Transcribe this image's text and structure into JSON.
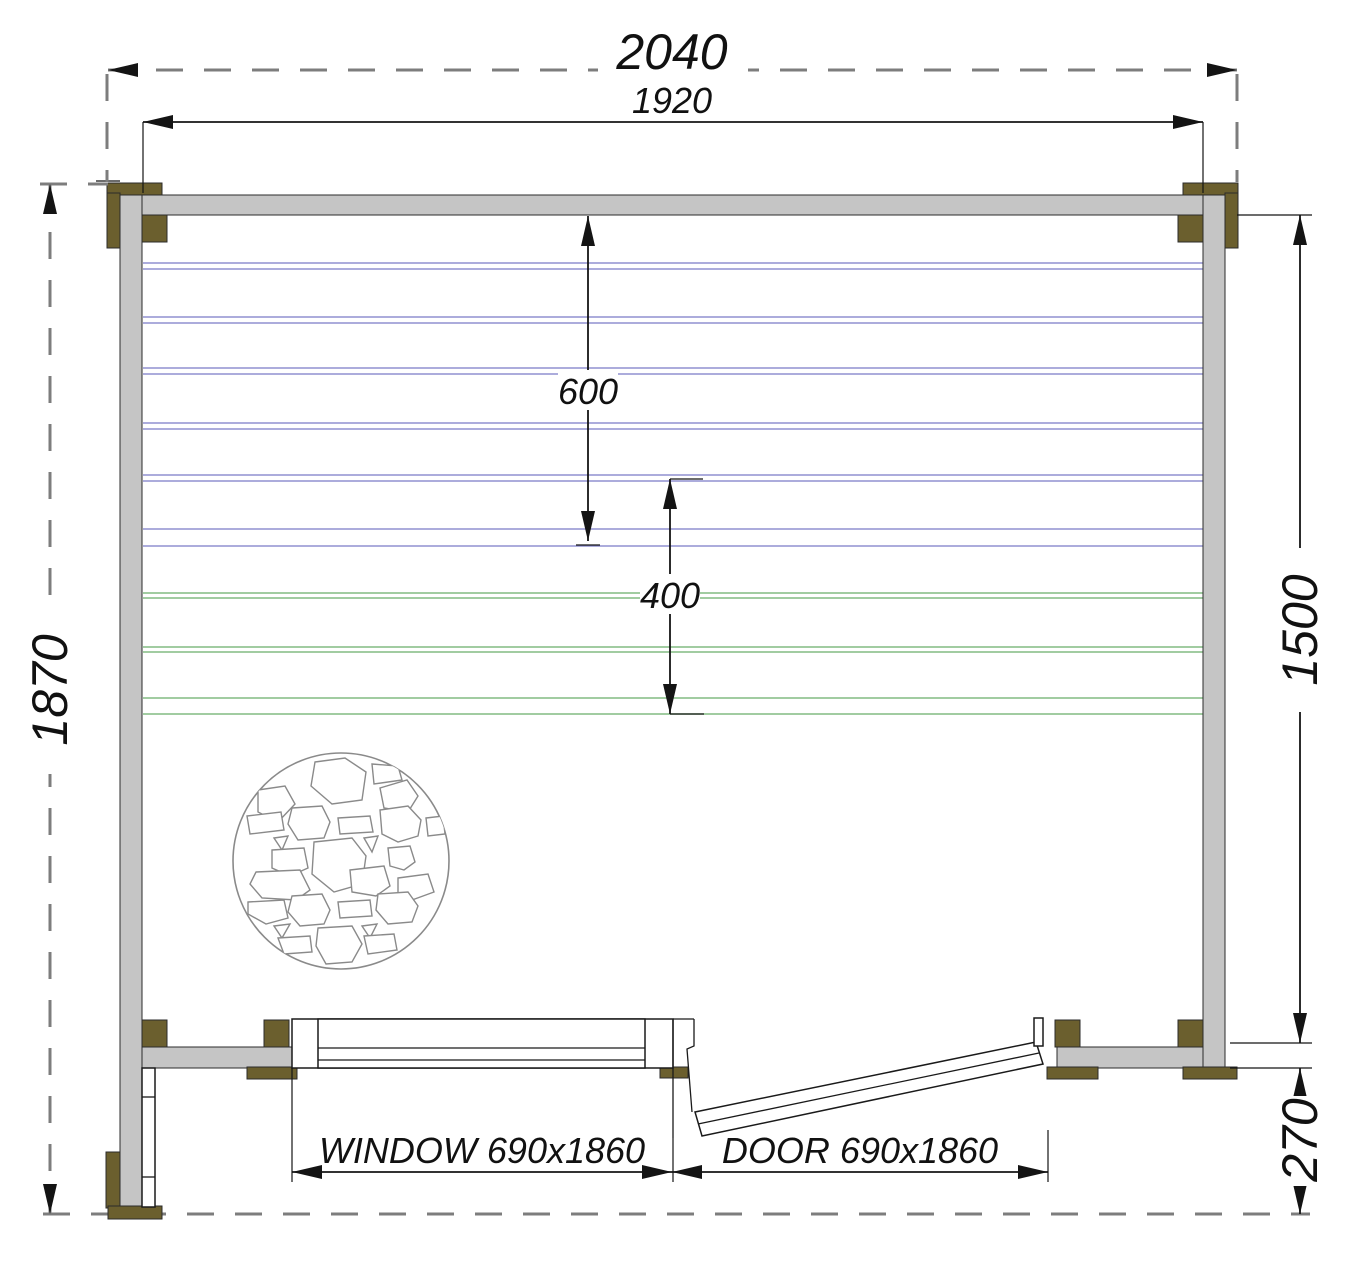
{
  "drawing": {
    "dimensions": {
      "overall_width": "2040",
      "frame_width": "1920",
      "left_height": "1870",
      "right_height": "1500",
      "upper_bench_depth": "600",
      "lower_bench_depth": "400",
      "porch_depth": "270",
      "window_label": "WINDOW 690x1860",
      "door_label": "DOOR 690x1860"
    },
    "colors": {
      "wall": "#c5c5c5",
      "timber": "#6b5f2e",
      "bench_blue": "#9191d0",
      "bench_green": "#82bb82",
      "dash": "#7d7d7d",
      "line": "#141414",
      "stone_outline": "#8a8a8a"
    }
  }
}
